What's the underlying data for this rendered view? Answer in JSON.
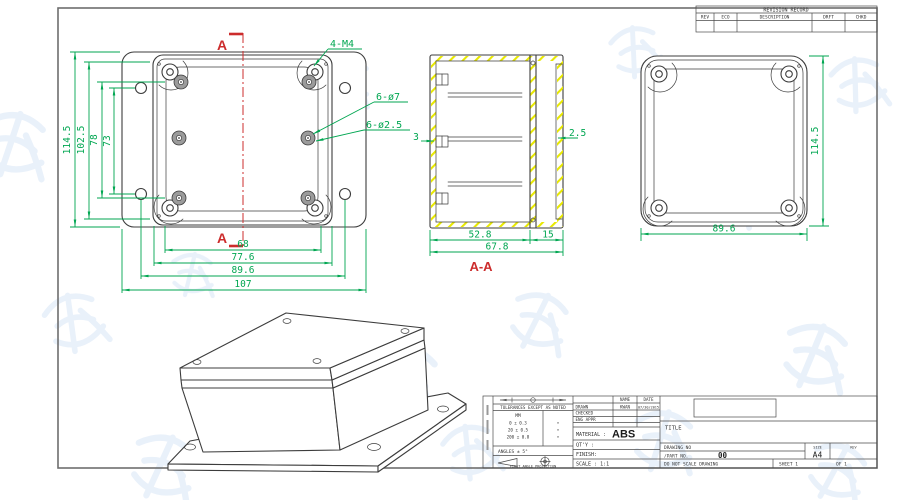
{
  "front_view": {
    "section_marker_top": "A",
    "section_marker_bottom": "A",
    "callout_corner_screws": "4-M4",
    "callout_flange_holes": "6-ø7",
    "callout_boss_holes": "6-ø2.5",
    "dim_overall_height": "114.5",
    "dim_lid_height": "102.5",
    "dim_inner_height_1": "78",
    "dim_inner_height_2": "73",
    "dim_inner_width": "68",
    "dim_lid_width": "77.6",
    "dim_hole_spacing": "89.6",
    "dim_overall_width": "107"
  },
  "section_view": {
    "title": "A-A",
    "dim_body_depth": "52.8",
    "dim_lid_depth": "15",
    "dim_total_depth": "67.8",
    "dim_wall": "2.5",
    "dim_boss_wall": "3"
  },
  "back_view": {
    "dim_width": "89.6",
    "dim_height": "114.5"
  },
  "revision_table": {
    "title": "REVISION RECORD",
    "columns": [
      "REV",
      "ECO",
      "DESCRIPTION",
      "DRFT",
      "CHKD"
    ]
  },
  "title_block": {
    "tolerance_note": "TOLERANCES EXCEPT AS NOTED",
    "tolerance_unit": "MM",
    "tolerance_rows": [
      "0 ± 0.3",
      "20 ± 0.5",
      "200 ± 0.8"
    ],
    "tolerance_marks": [
      "•",
      "•",
      "•"
    ],
    "angles": "ANGLES ± 5°",
    "projection": "FIRST ANGLE PROJECTION",
    "name_header": "NAME",
    "date_header": "DATE",
    "drawn_label": "DRAWN",
    "drawn_name": "KWAN",
    "drawn_date": "07/30/2015",
    "checked_label": "CHECKED",
    "eng_appr_label": "ENG APPR",
    "material_label": "MATERIAL :",
    "material_value": "ABS",
    "qty_label": "QT'Y :",
    "finish_label": "FINISH:",
    "scale_label": "SCALE : 1:1",
    "title_label": "TITLE",
    "drawing_no_label": "DRAWING NO",
    "part_no_label": "/PART  NO.",
    "part_no_value": "00",
    "size_label": "SIZE",
    "size_value": "A4",
    "rev_label": "REV",
    "do_not_scale": "DO NOT SCALE DRAWING",
    "sheet_label": "SHEET 1",
    "of_label": "OF 1"
  },
  "colors": {
    "dimension_green": "#00a651",
    "section_red": "#cc2c2c",
    "hatch_yellow": "#e8e800",
    "line_dark": "#3c3c3c",
    "watermark_blue": "#cfdff4"
  }
}
